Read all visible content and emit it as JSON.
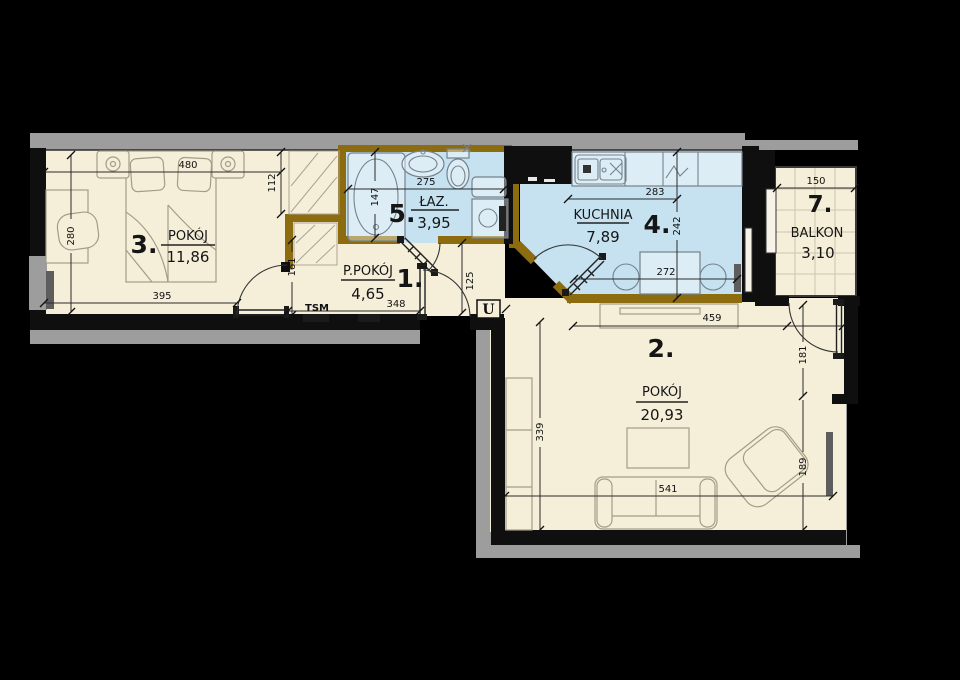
{
  "plan": {
    "rooms": [
      {
        "number": "1.",
        "name": "P.POKÓJ",
        "area": "4,65"
      },
      {
        "number": "2.",
        "name": "POKÓJ",
        "area": "20,93"
      },
      {
        "number": "3.",
        "name": "POKÓJ",
        "area": "11,86"
      },
      {
        "number": "4.",
        "name": "KUCHNIA",
        "area": "7,89"
      },
      {
        "number": "5.",
        "name": "ŁAZ.",
        "area": "3,95"
      },
      {
        "number": "7.",
        "name": "BALKON",
        "area": "3,10"
      }
    ],
    "dims": {
      "room3_top": "480",
      "wardrobe_height": "112",
      "room3_left": "280",
      "room3_bottom": "395",
      "hall_door": "161",
      "bath_width": "275",
      "bath_depth": "147",
      "hall_width": "348",
      "vestibule": "125",
      "kitchen_width": "283",
      "kitchen_depth": "242",
      "kitchen_table": "272",
      "balcony_width": "150",
      "room2_top": "459",
      "room2_right_upper": "181",
      "room2_right_lower": "189",
      "room2_left": "339",
      "room2_bottom": "541"
    },
    "labels": {
      "tsm": "TSM",
      "entry_beam": "U"
    },
    "colors": {
      "background": "#000000",
      "floor": "#f5efda",
      "wet_floor": "#c6e2f1",
      "partition_wall": "#8d6c10",
      "exterior_band": "#9d9d9d"
    }
  }
}
